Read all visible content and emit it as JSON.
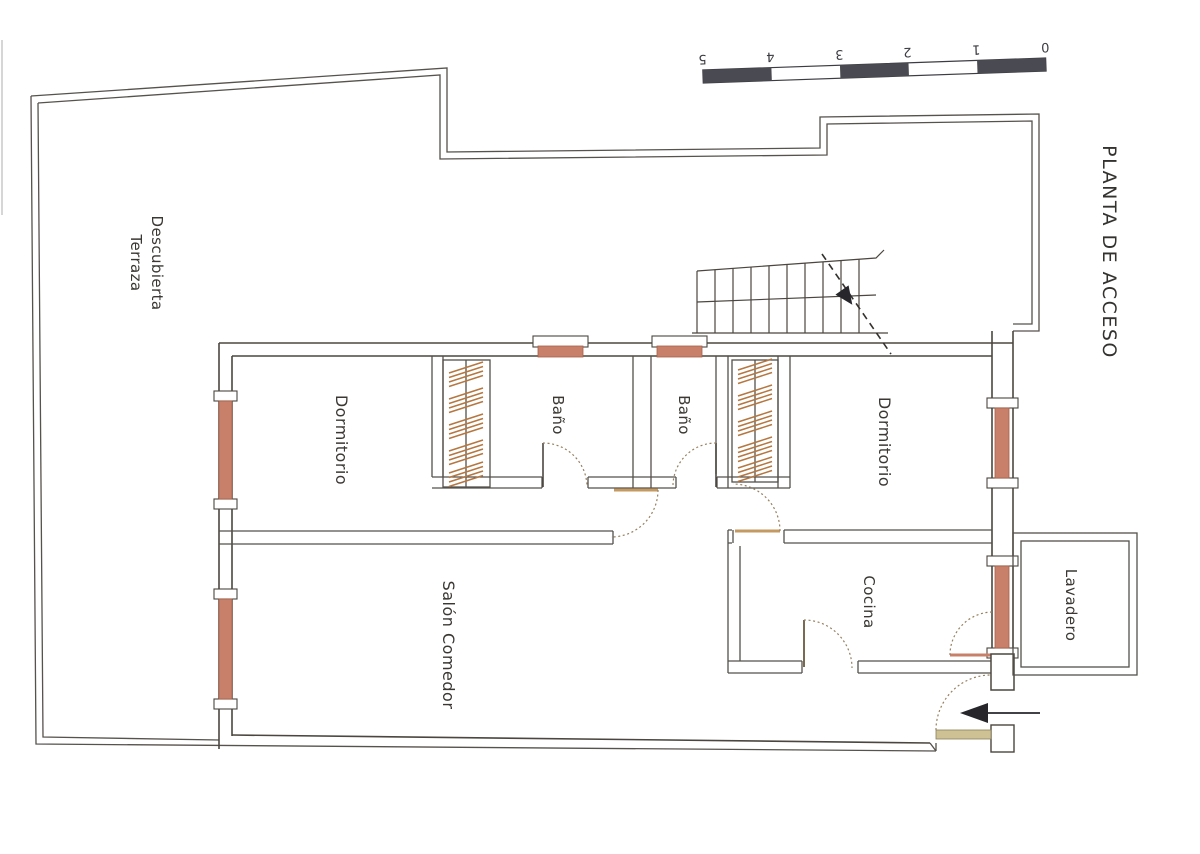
{
  "plan": {
    "title": "PLANTA DE ACCESO",
    "rooms": {
      "terraza": {
        "line1": "Terraza",
        "line2": "Descubierta"
      },
      "dormitorio_left": "Dormitorio",
      "bano_left": "Baño",
      "bano_right": "Baño",
      "dormitorio_right": "Dormitorio",
      "salon": "Salón Comedor",
      "cocina": "Cocina",
      "lavadero": "Lavadero"
    },
    "scale_bar": {
      "labels": [
        "0",
        "1",
        "2",
        "3",
        "4",
        "5"
      ]
    },
    "colors": {
      "line": "#4b463f",
      "window": "#c9806a",
      "wardrobe_hatch": "#b5763f",
      "door_leaf": "#c49a62",
      "threshold": "#cec294",
      "arrow": "#26262b",
      "paper": "#ffffff"
    }
  }
}
